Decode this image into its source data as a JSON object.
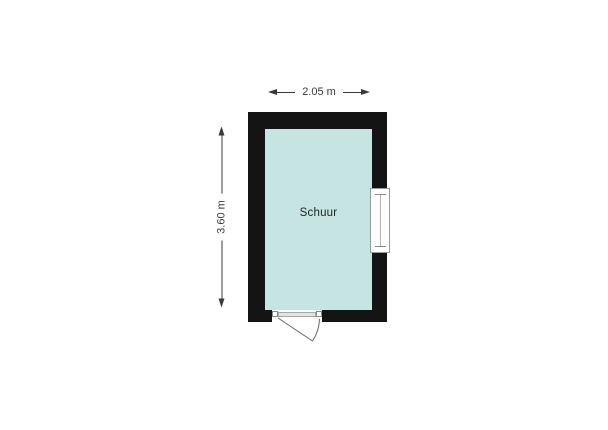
{
  "plan": {
    "room_label": "Schuur",
    "dimensions": {
      "width_label": "2.05 m",
      "height_label": "3.60 m"
    },
    "features": {
      "window": "window-right-wall",
      "door": "door-bottom-wall-outward-swing"
    }
  },
  "colors": {
    "wall": "#141414",
    "floor": "#c6e5e2",
    "dimension_text": "#3a3a3a",
    "door_line": "#666666",
    "background": "#ffffff"
  }
}
